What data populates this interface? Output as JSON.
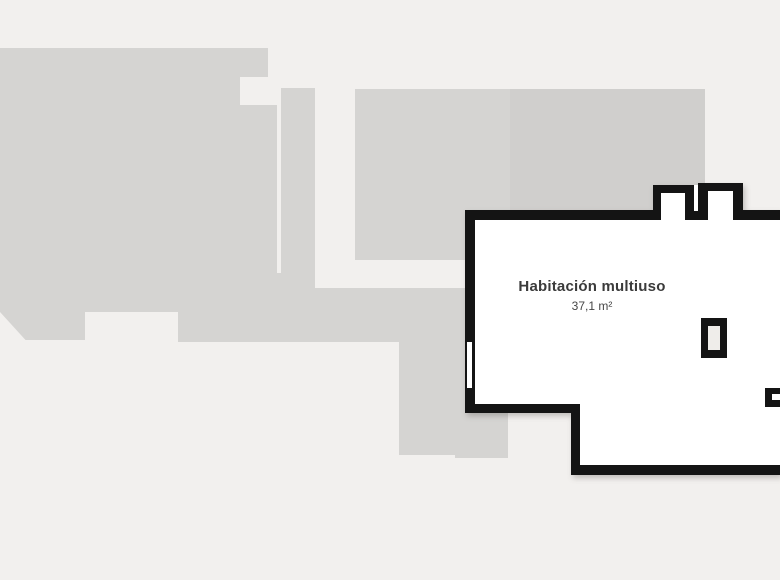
{
  "plan": {
    "room": {
      "name": "Habitación multiuso",
      "area": "37,1 m²"
    }
  },
  "colors": {
    "background": "#f2f0ee",
    "building": "#d5d4d2",
    "building_dark": "#d0cfcd",
    "wall": "#141414",
    "room_fill": "#ffffff",
    "column_fill": "#efedea",
    "label": "#3b3b3b",
    "area_label": "#474747"
  }
}
